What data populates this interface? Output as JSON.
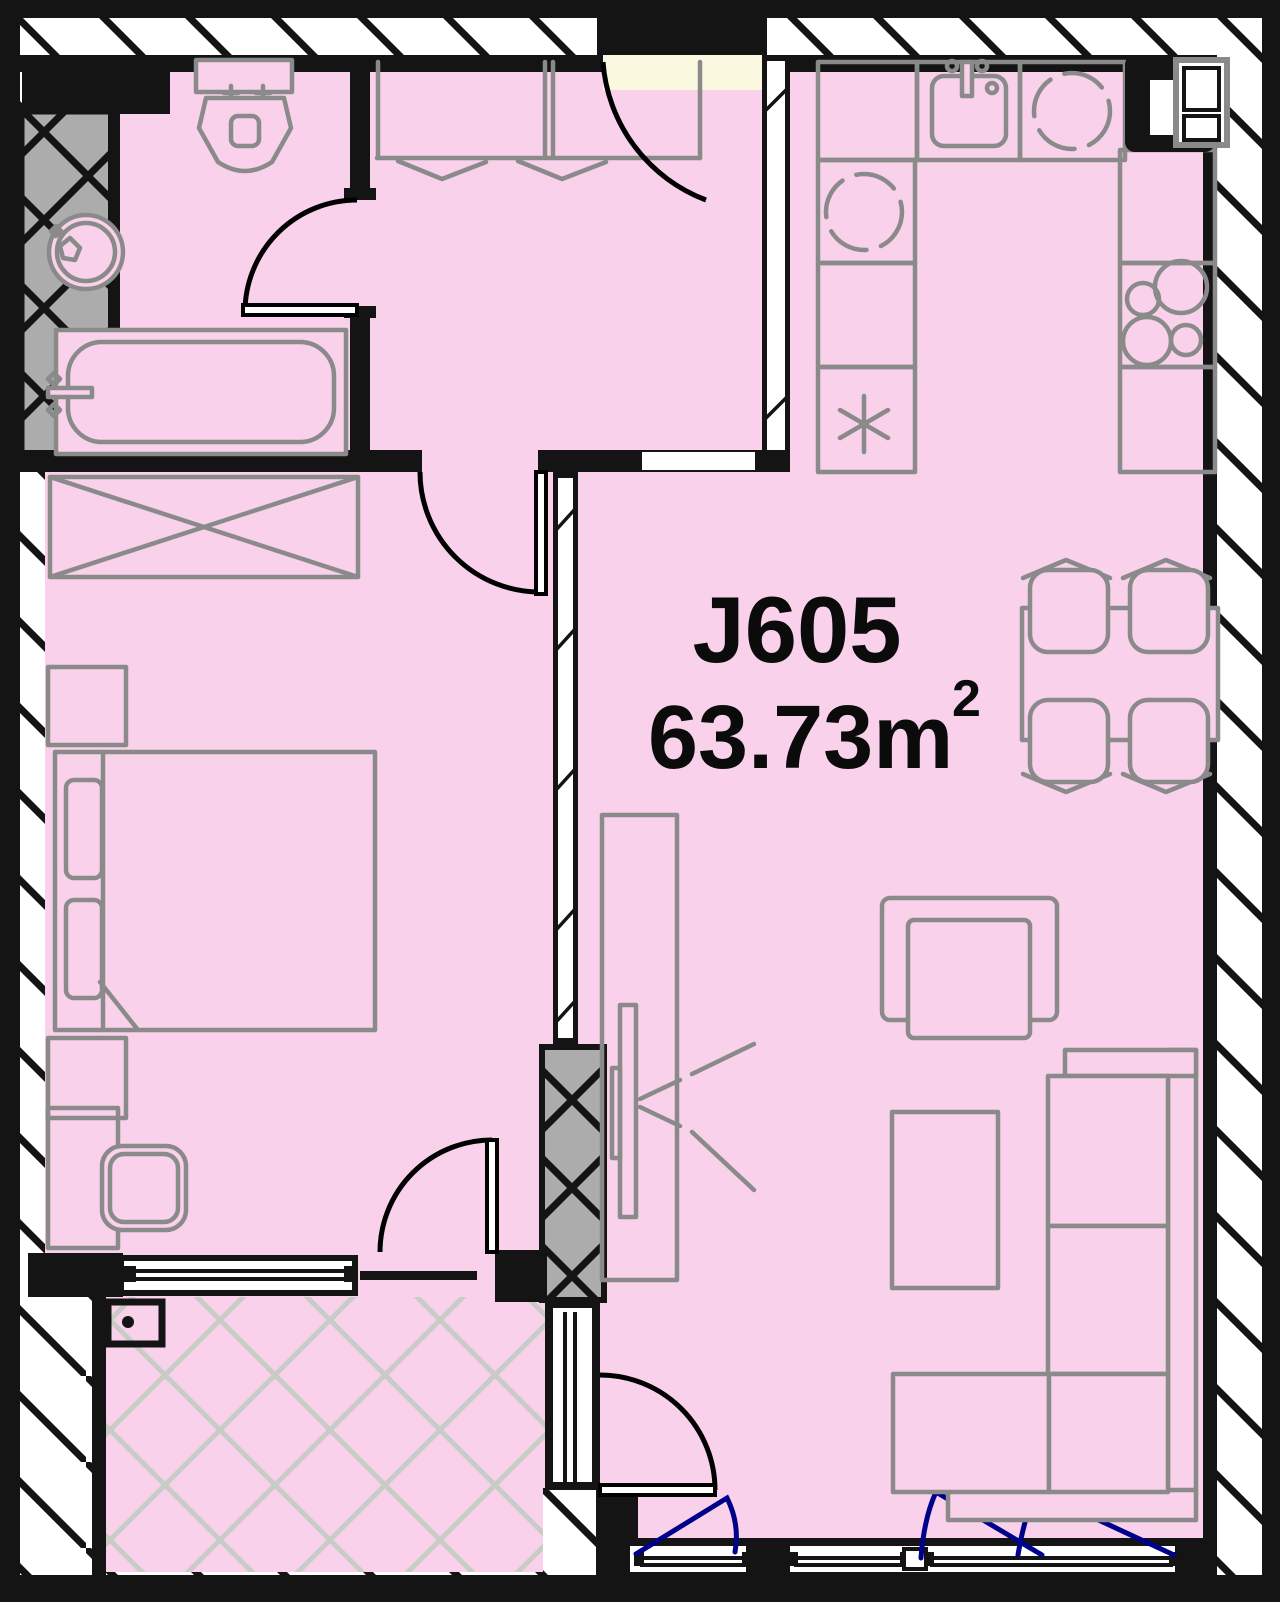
{
  "unit": {
    "label": "J605",
    "area_value": "63.73m",
    "area_exponent": "2"
  },
  "colors": {
    "room-pink": "#F9D1EA",
    "balcony-grid": "#C7CCC7",
    "furniture-gray": "#8A8A8A",
    "wall-black": "#141414",
    "window-navy": "#00008B",
    "threshold-cream": "#FAF8DF",
    "shaft-gray": "#ACACAC"
  }
}
